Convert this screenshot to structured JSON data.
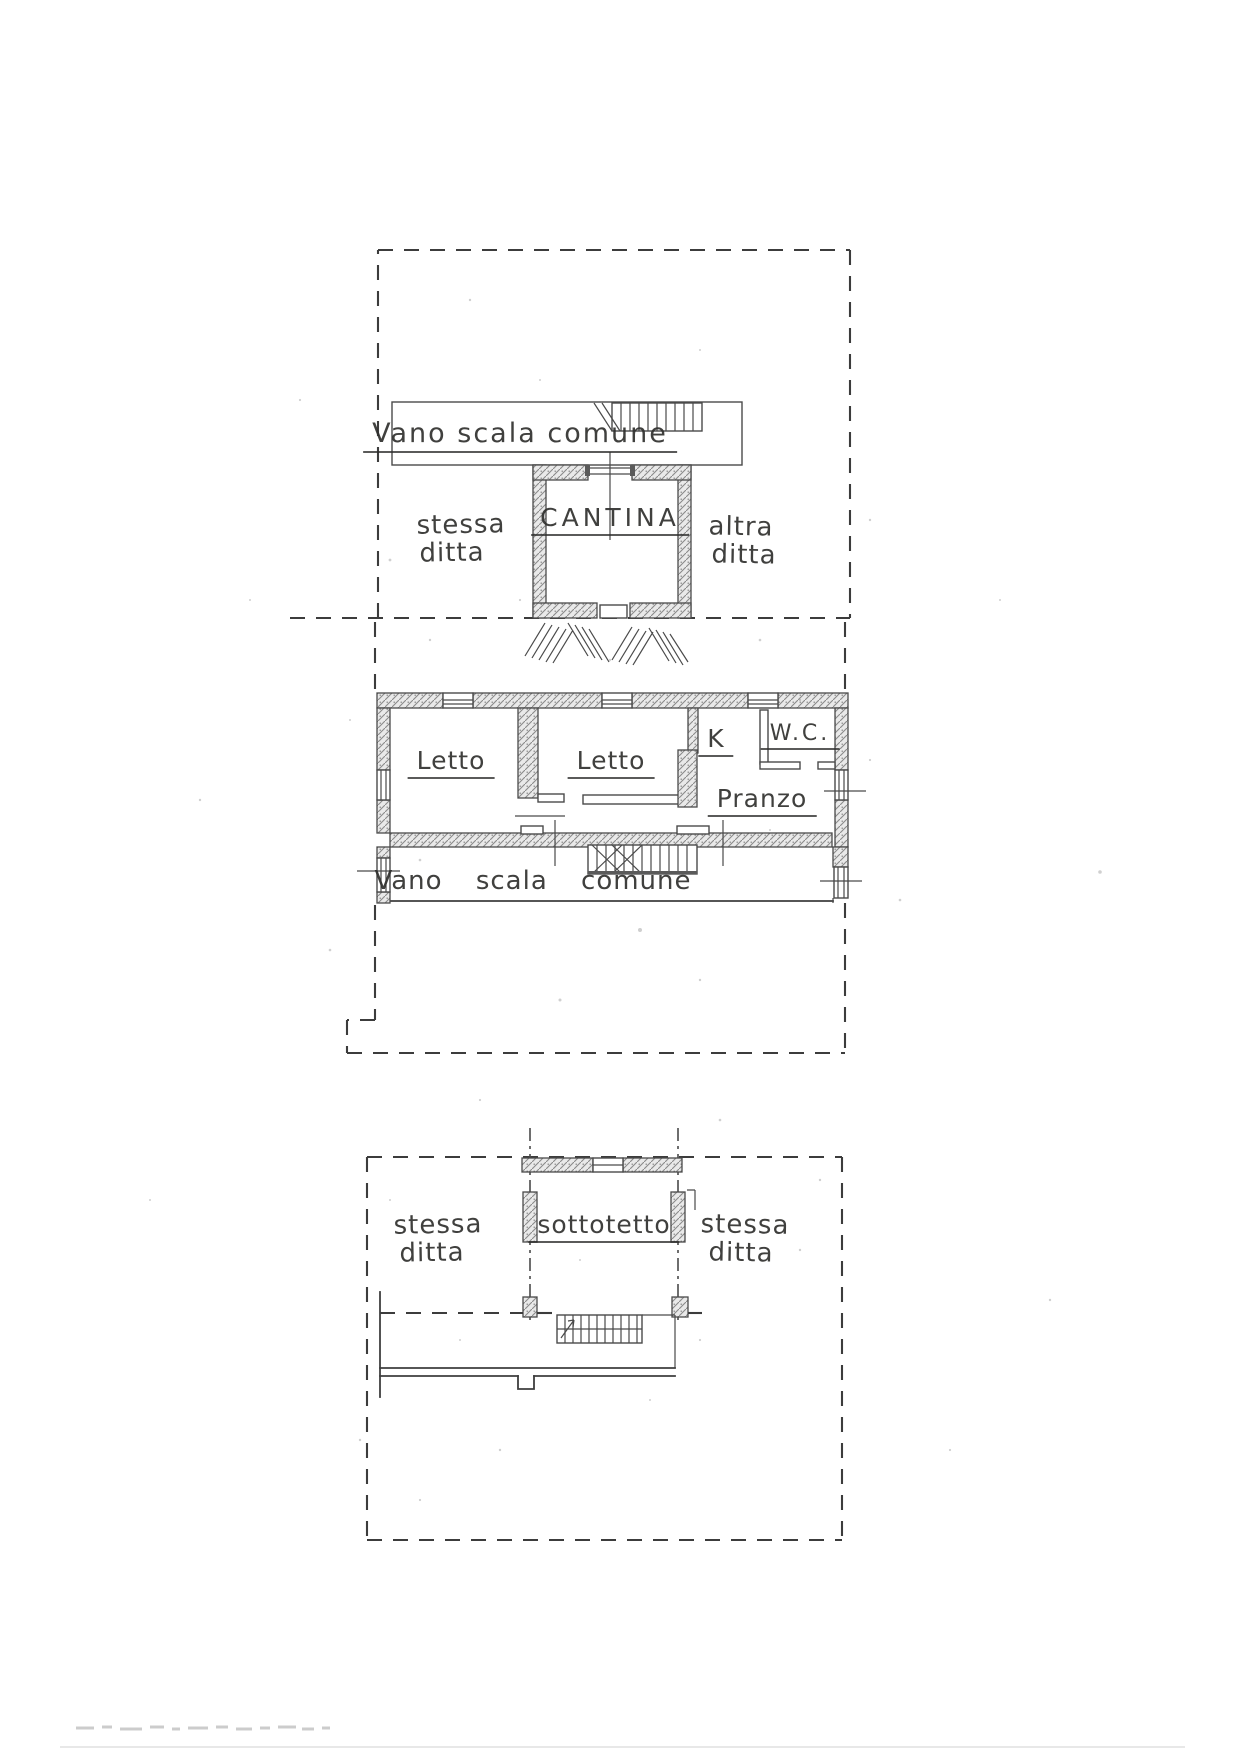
{
  "plans": {
    "basement": {
      "stairwell_label": "Vano scala comune",
      "room_label": "CANTINA",
      "left_owner": {
        "line1": "stessa",
        "line2": "ditta"
      },
      "right_owner": {
        "line1": "altra",
        "line2": "ditta"
      }
    },
    "first_floor": {
      "bedroom_left_label": "Letto",
      "bedroom_right_label": "Letto",
      "kitchen_label": "K",
      "wc_label": "W.C.",
      "dining_label": "Pranzo",
      "stairwell_label": "Vano scala comune"
    },
    "attic": {
      "room_label": "sottotetto",
      "left_owner": {
        "line1": "stessa",
        "line2": "ditta"
      },
      "right_owner": {
        "line1": "stessa",
        "line2": "ditta"
      }
    }
  },
  "colors": {
    "paper": "#ffffff",
    "ink": "#3e3e3e",
    "wall_fill": "#e9e9e9"
  }
}
